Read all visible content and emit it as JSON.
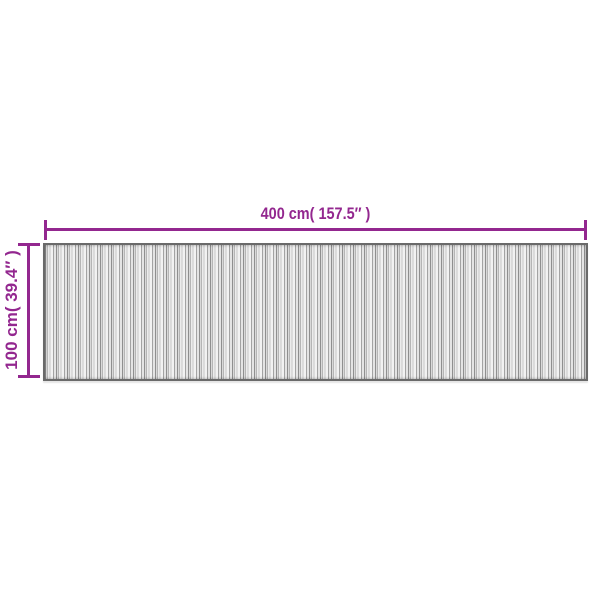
{
  "page": {
    "background_color": "#ffffff"
  },
  "diagram": {
    "accent_color": "#93278F",
    "width_dimension": {
      "label": "400 cm( 157.5″ )"
    },
    "height_dimension": {
      "label": "100 cm( 39.4″ )"
    },
    "mat": {
      "border_color": "#6a6a6a",
      "stripe_colors": [
        "#8f8f8f",
        "#d9d9d9",
        "#b5b5b5",
        "#ececec",
        "#c7c7c7",
        "#f2f2f2",
        "#a3a3a3",
        "#e4e4e4"
      ]
    }
  }
}
